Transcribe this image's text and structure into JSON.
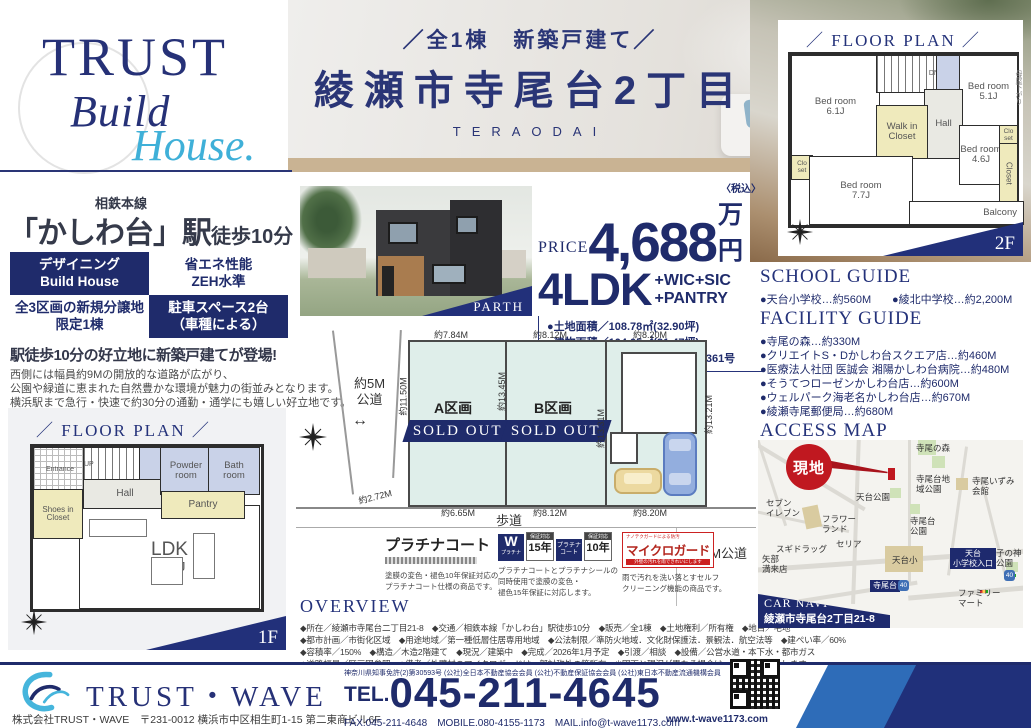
{
  "brand": {
    "top": "TRUST",
    "mid": "Build",
    "bot": "House."
  },
  "header": {
    "subtitle": "／全1棟　新築戸建て／",
    "title": "綾瀬市寺尾台2丁目",
    "romaji": "TERAODAI"
  },
  "plan2f": {
    "heading": "FLOOR PLAN",
    "floor": "2F",
    "note": "母屋下がり",
    "bed1": "Bed room",
    "bed1_size": "6.1J",
    "wic": "Walk in Closet",
    "hall": "Hall",
    "dn": "DN",
    "bed2": "Bed room",
    "bed2_size": "5.1J",
    "bed3": "Bed room",
    "bed3_size": "4.6J",
    "closet": "Closet",
    "clo1": "Clo set",
    "clo2": "Clo set",
    "bed4": "Bed room",
    "bed4_size": "7.7J",
    "balcony": "Balcony"
  },
  "station": {
    "line": "相鉄本線",
    "name": "「かしわ台」駅",
    "walk": "徒歩10分"
  },
  "badges": {
    "b1a": "デザイニング",
    "b1b": "Build House",
    "b2a": "省エネ性能",
    "b2b": "ZEH水準",
    "b3a": "全3区画の新規分譲地",
    "b3b": "限定1棟",
    "b4a": "駐車スペース2台",
    "b4b": "（車種による）"
  },
  "catch": {
    "headline": "駅徒歩10分の好立地に新築戸建てが登場!",
    "line1": "西側には幅員約9Mの開放的な道路が広がり、",
    "line2": "公園や緑道に恵まれた自然豊かな環境が魅力の街並みとなります。",
    "line3": "横浜駅まで急行・快速で約30分の通勤・通学にも嬉しい好立地です。"
  },
  "render": {
    "caption": "PARTH"
  },
  "price": {
    "label": "PRICE",
    "amount": "4,688",
    "tax": "〈税込〉",
    "unit": "万円",
    "ldk": "4LDK",
    "opt1": "+WIC+SIC",
    "opt2": "+PANTRY",
    "d1": "●土地面積／108.78㎡(32.90坪)",
    "d2": "●建物面積／104.05㎡(31.47坪)",
    "d3": "●建築確認番号／第25KAK建確1361号"
  },
  "siteplan": {
    "road_left": "約5M\n公道",
    "dim_top1": "約7.84M",
    "dim_top2": "約8.12M",
    "dim_top3": "約8.20M",
    "dim_a_left": "約11.50M",
    "dim_b_left": "約13.45M",
    "dim_b_right": "約13.31M",
    "dim_c_right": "約13.21M",
    "dim_bot0": "約2.72M",
    "dim_bot1": "約6.65M",
    "dim_bot2": "約8.12M",
    "dim_bot3": "約8.20M",
    "lot_a": "A区画",
    "lot_b": "B区画",
    "sold_a": "SOLD OUT",
    "sold_b": "SOLD OUT",
    "sidewalk": "歩道",
    "road_bottom": "約9M公道"
  },
  "plan1f": {
    "heading": "FLOOR PLAN",
    "floor": "1F",
    "entrance": "Entrance",
    "up": "UP",
    "hall": "Hall",
    "powder": "Powder room",
    "bath": "Bath room",
    "shoes": "Shoes in Closet",
    "pantry": "Pantry",
    "ldk": "LDK",
    "ldk_size": "18.9J"
  },
  "warranty": {
    "p_name": "プラチナコート",
    "p_desc1": "塗膜の変色・褪色10年保証対応の",
    "p_desc2": "プラチナコート仕様の商品です。",
    "w_letter": "W",
    "w_sub": "プラチナ",
    "y15_cap": "保証対応",
    "y15": "15年",
    "mid": "プラチナコート",
    "y10_cap": "保証対応",
    "y10": "10年",
    "w_desc1": "プラチナコートとプラチナシールの",
    "w_desc2": "同時使用で塗膜の変色・",
    "w_desc3": "褪色15年保証に対応します。",
    "m_top": "ナノテクガードによる防汚",
    "m_name": "マイクロガード",
    "m_strip": "外壁の汚れを雨できれいにします",
    "m_desc1": "雨で汚れを洗い落とすセルフ",
    "m_desc2": "クリーニング機能の商品です。"
  },
  "overview": {
    "heading": "OVERVIEW",
    "line1": "◆所在／綾瀬市寺尾台二丁目21-8　◆交通／相鉄本線「かしわ台」駅徒歩10分　◆販売／全1棟　◆土地権利／所有権　◆地目／宅地",
    "line2": "◆都市計画／市街化区域　◆用途地域／第一種低層住居専用地域　◆公法制限／準防火地域．文化財保護法．景観法．航空法等　◆建ぺい率／60%",
    "line3": "◆容積率／150%　◆構造／木造2階建て　◆現況／建築中　◆完成／2026年1月予定　◆引渡／相談　◆設備／公営水道・本下水・都市ガス",
    "line4": "◆道路幅員／区画図参照　◆備考／外壁材のマイクロガードは一部対称外の箇所有。※図面と現況が異なる場合は、現況を優先とします。"
  },
  "school": {
    "heading": "SCHOOL GUIDE",
    "item1": "●天台小学校…約560M",
    "item2": "●綾北中学校…約2,200M"
  },
  "facility": {
    "heading": "FACILITY GUIDE",
    "items": [
      "●寺尾の森…約330M",
      "●クリエイトS・Dかしわ台スクエア店…約460M",
      "●医療法人社団 医誠会 湘陽かしわ台病院…約480M",
      "●そうてつローゼンかしわ台店…約600M",
      "●ウェルパーク海老名かしわ台店…約670M",
      "●綾瀬寺尾郵便局…約680M"
    ]
  },
  "map": {
    "heading": "ACCESS MAP",
    "genchi": "現地",
    "teraonomori": "寺尾の森",
    "chiikipark": "寺尾台地域公園",
    "izumi": "寺尾いずみ会館",
    "tendaipark": "天台公園",
    "teraodaipark": "寺尾台公園",
    "seven": "セブン\nイレブン",
    "flower": "フラワー\nランド",
    "sugi": "スギドラッグ",
    "seria": "セリア",
    "yabe": "矢部\n満来店",
    "tendaisho": "天台小",
    "iriguchi": "天台\n小学校入口",
    "teraodai": "寺尾台",
    "route40a": "40",
    "route40b": "40",
    "konokami": "子の神\n公園",
    "famima": "ファミリー\nマート",
    "carnavi": "CAR NAVI",
    "caraddr": "綾瀬市寺尾台2丁目21-8"
  },
  "footer": {
    "logo": "TRUST・WAVE",
    "company": "株式会社TRUST・WAVE　〒231-0012 横浜市中区相生町1-15 第二東商ビル6F",
    "license": "神奈川県知事免許(2)第30593号 (公社)全日本不動産協会会員 (公社)不動産保証協会会員 (公社)東日本不動産流通機構会員",
    "tel_label": "TEL.",
    "tel": "045-211-4645",
    "contacts": "FAX.045-211-4648　MOBILE.080-4155-1173　MAIL.info@t-wave1173.com",
    "web": "www.t-wave1173.com"
  },
  "colors": {
    "navy": "#1f2b6b",
    "cyan": "#45b5dc",
    "red": "#c01820"
  }
}
